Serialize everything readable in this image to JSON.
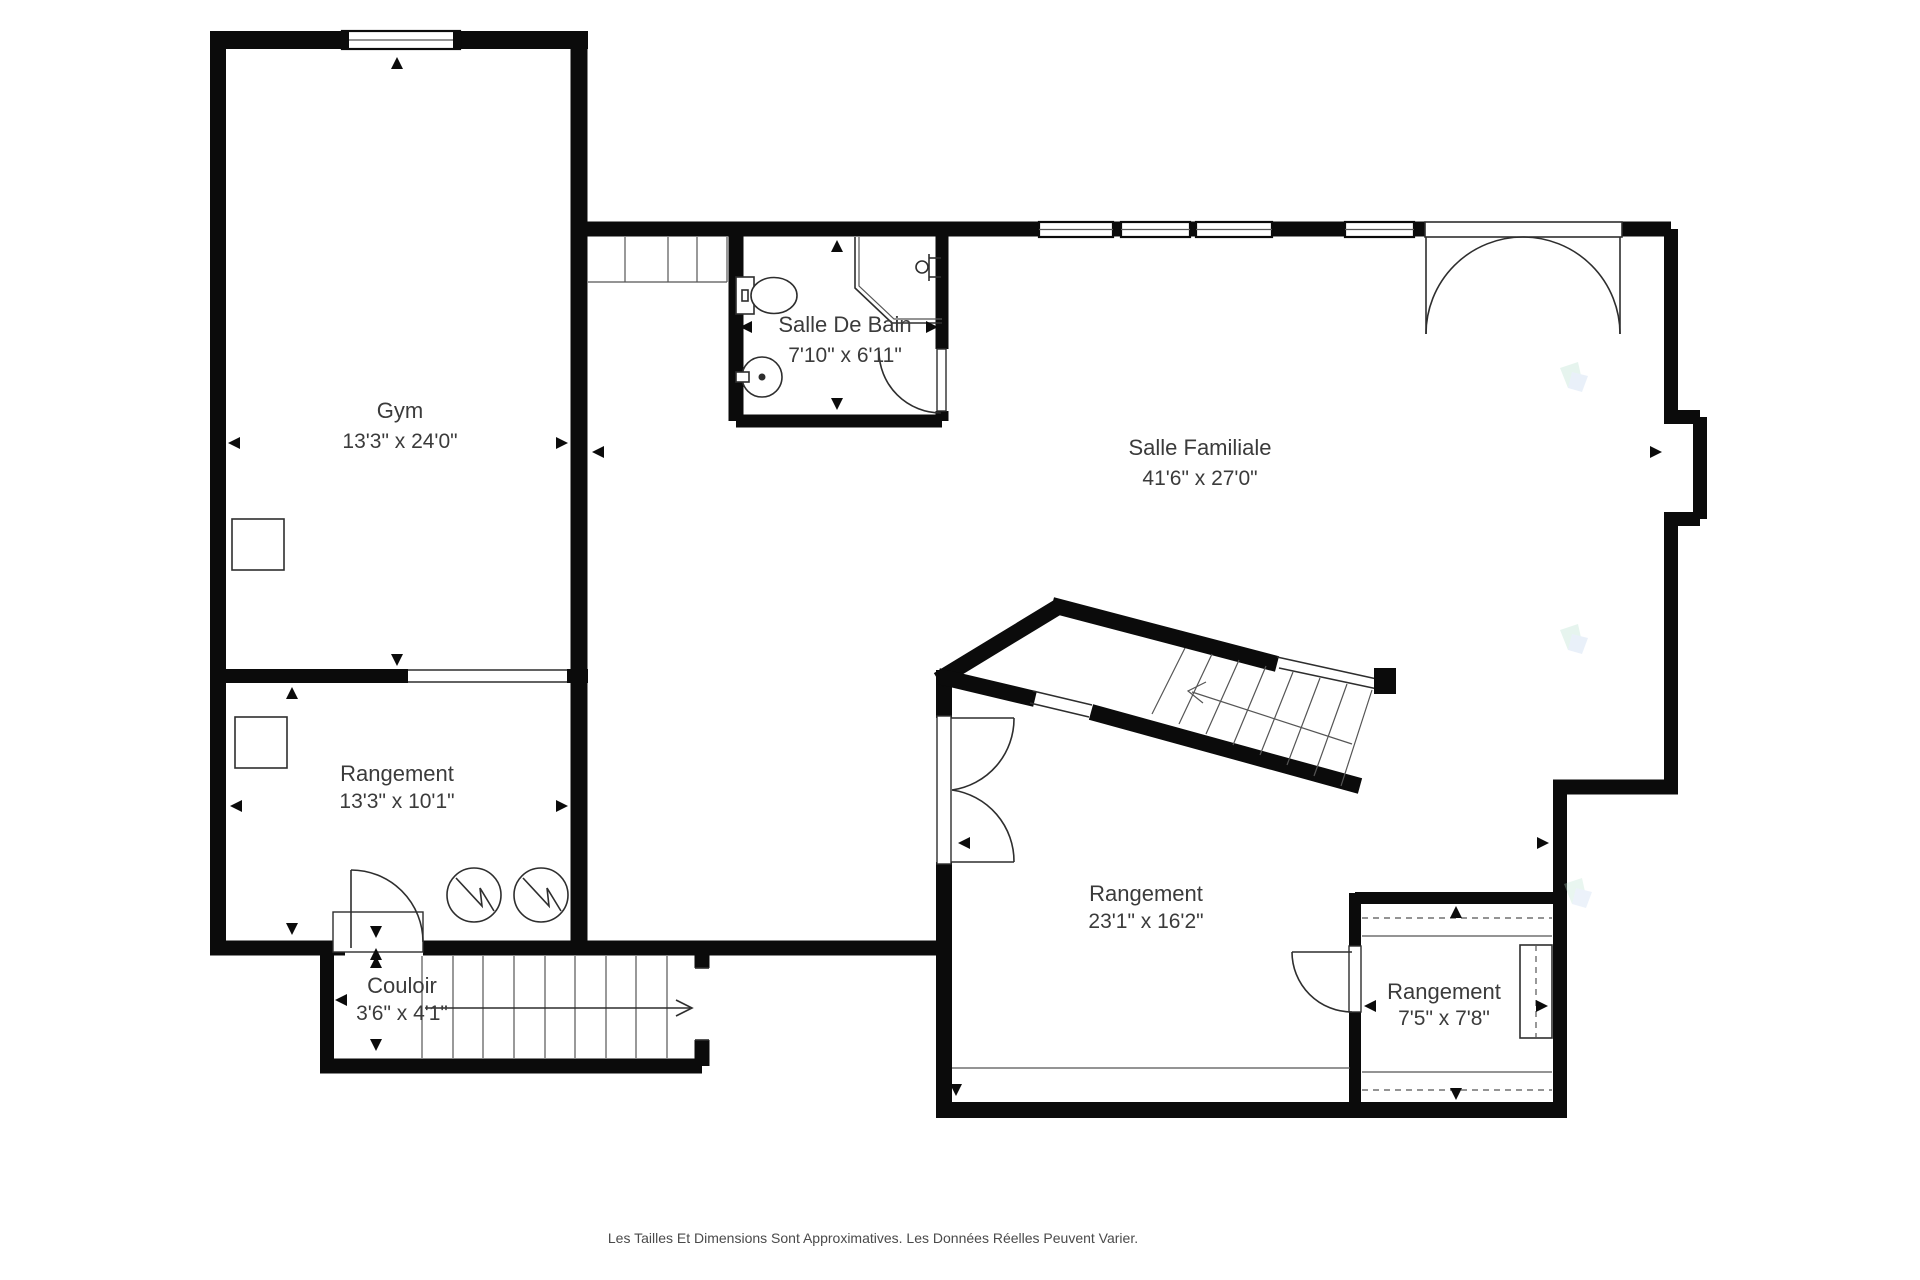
{
  "floor_plan": {
    "rooms": [
      {
        "id": "gym",
        "name": "Gym",
        "dimensions": "13'3\" x 24'0\""
      },
      {
        "id": "salle_de_bain",
        "name": "Salle De Bain",
        "dimensions": "7'10\" x 6'11\""
      },
      {
        "id": "salle_familiale",
        "name": "Salle Familiale",
        "dimensions": "41'6\" x 27'0\""
      },
      {
        "id": "rangement_ouest",
        "name": "Rangement",
        "dimensions": "13'3\" x 10'1\""
      },
      {
        "id": "couloir",
        "name": "Couloir",
        "dimensions": "3'6\" x 4'1\""
      },
      {
        "id": "rangement_central",
        "name": "Rangement",
        "dimensions": "23'1\" x 16'2\""
      },
      {
        "id": "rangement_est",
        "name": "Rangement",
        "dimensions": "7'5\" x 7'8\""
      }
    ],
    "disclaimer": "Les Tailles Et Dimensions Sont Approximatives. Les Données Réelles Peuvent Varier.",
    "colors": {
      "walls": "#0b0b0b",
      "text": "#3b3b3b",
      "background": "#ffffff",
      "watermark_green": "#b9e2cf",
      "watermark_blue": "#c3d7ef"
    }
  }
}
